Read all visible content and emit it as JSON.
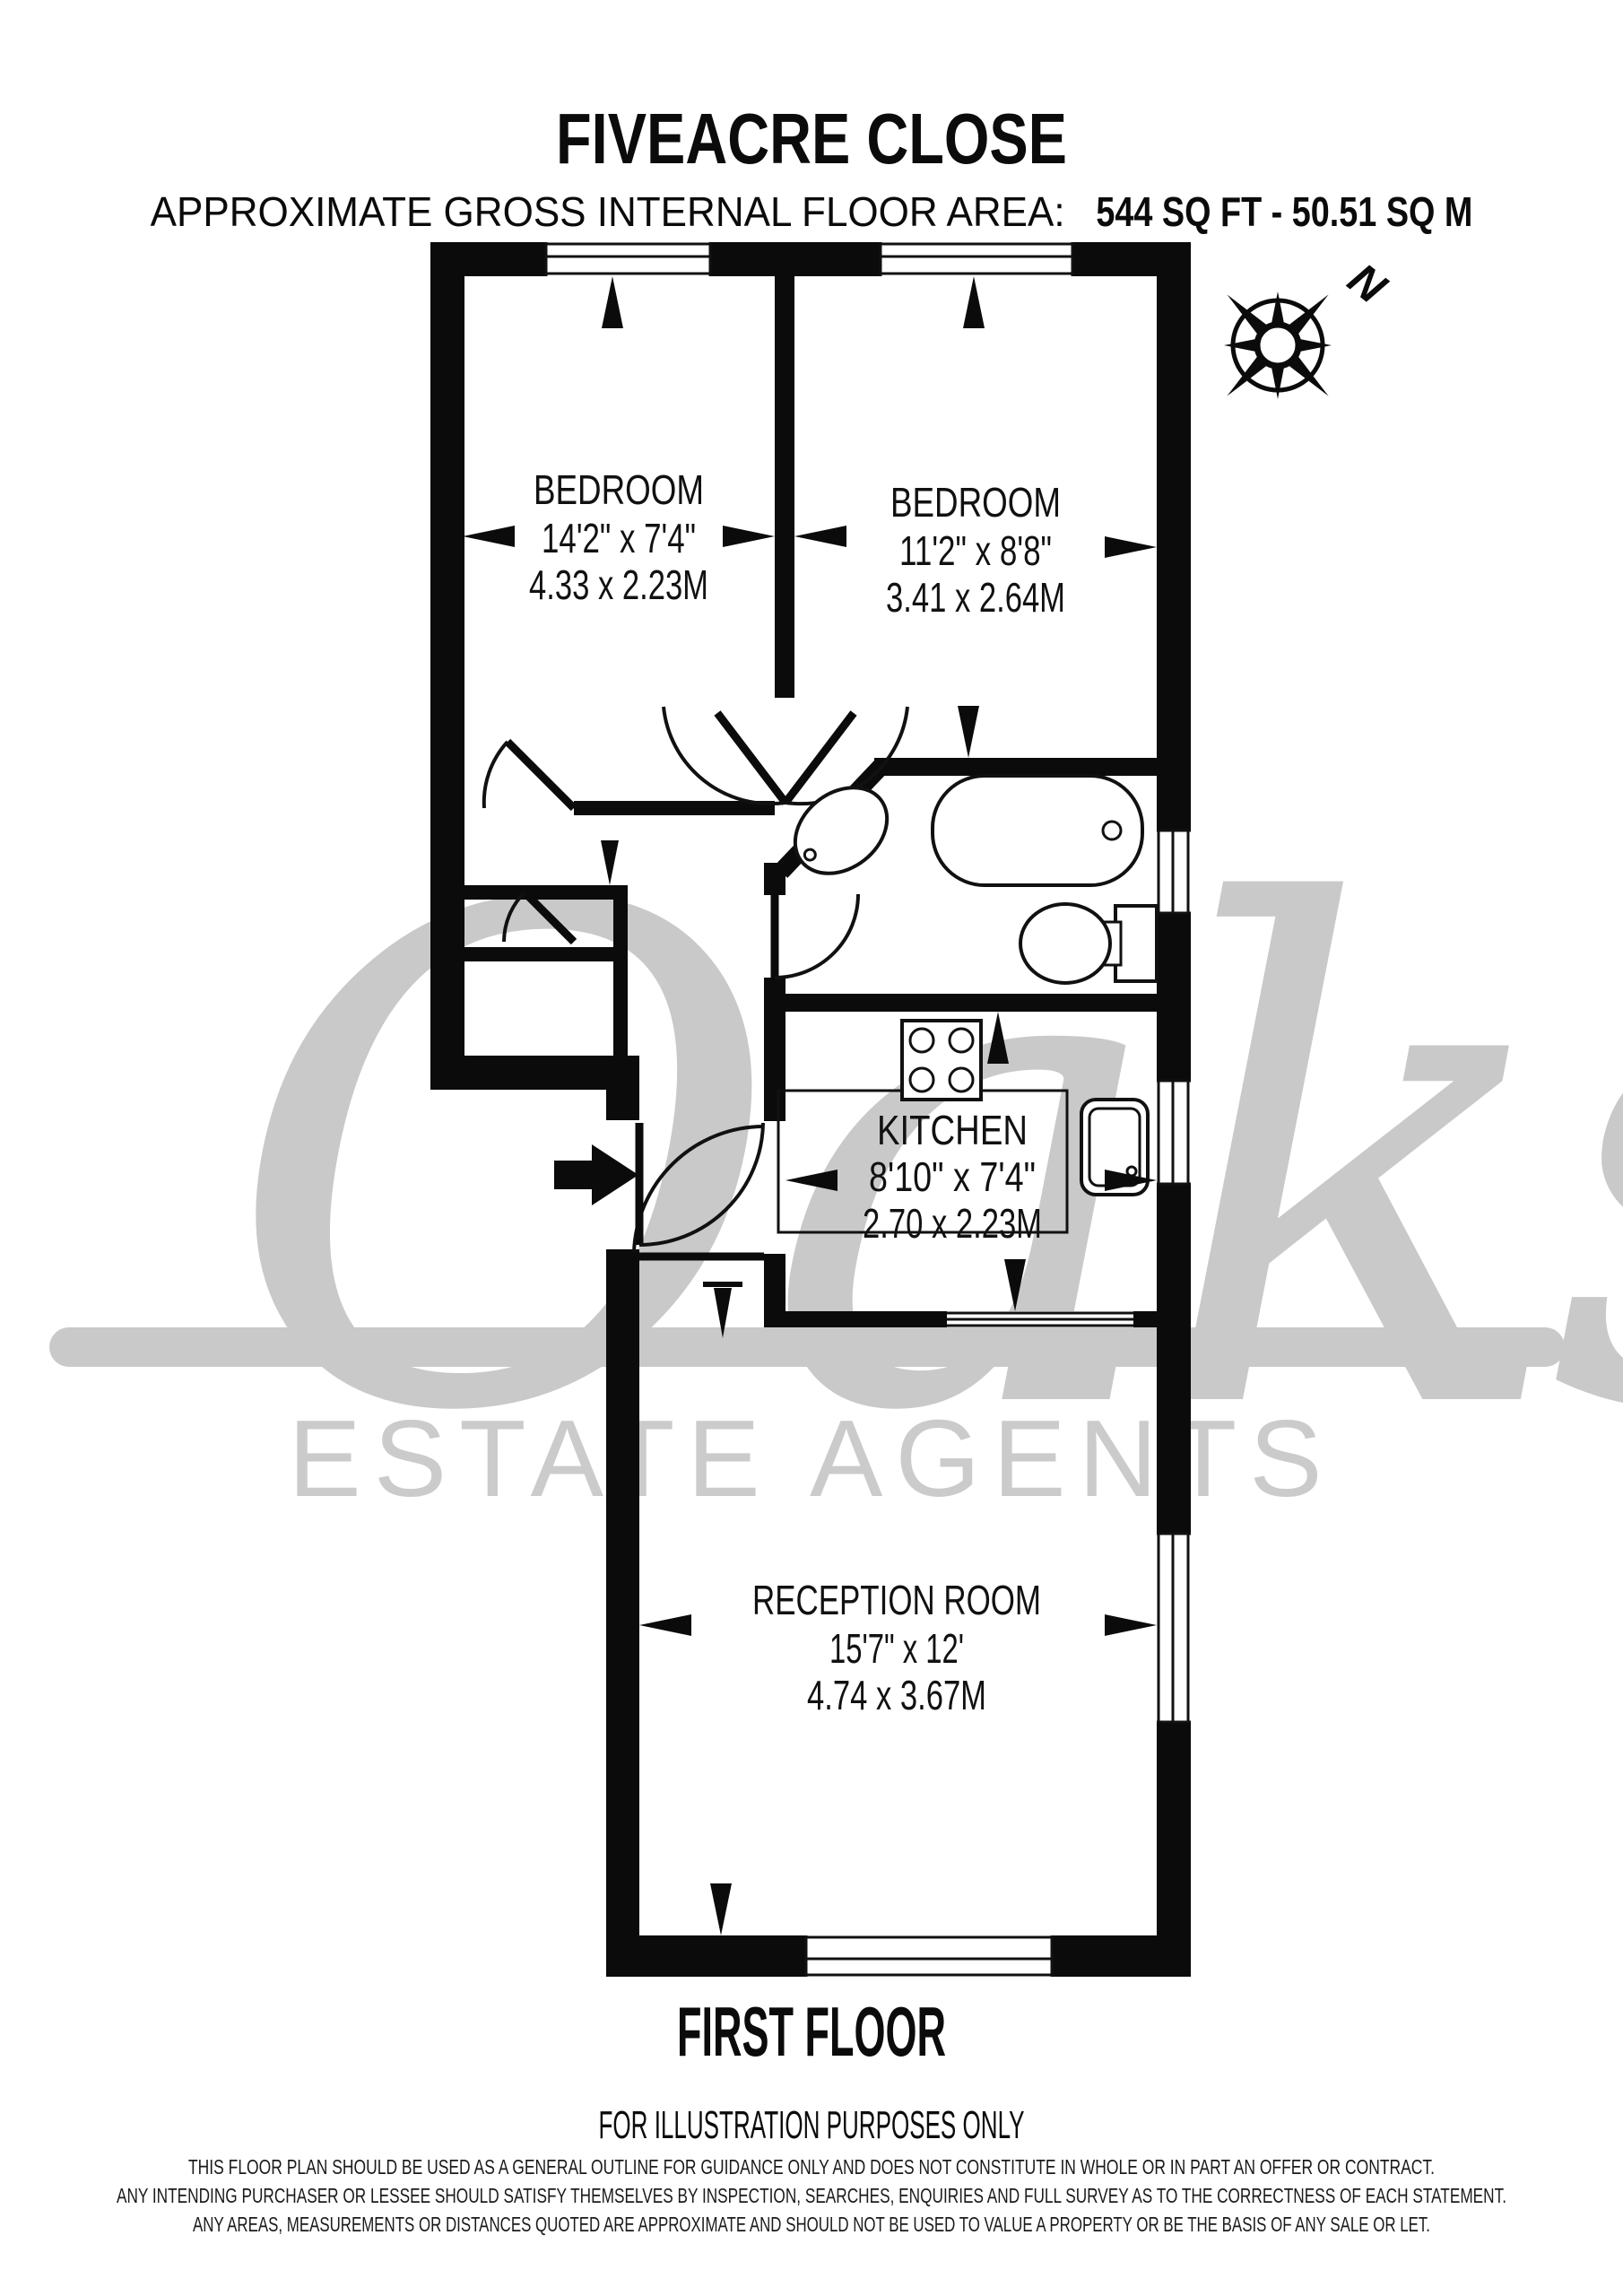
{
  "header": {
    "title": "FIVEACRE CLOSE",
    "area_label": "APPROXIMATE GROSS INTERNAL FLOOR AREA:",
    "area_value": "544 SQ FT - 50.51 SQ M"
  },
  "compass": {
    "north_label": "N"
  },
  "rooms": {
    "bedroom1": {
      "name": "BEDROOM",
      "imperial": "14'2\" x 7'4\"",
      "metric": "4.33 x 2.23M"
    },
    "bedroom2": {
      "name": "BEDROOM",
      "imperial": "11'2\" x 8'8\"",
      "metric": "3.41 x 2.64M"
    },
    "kitchen": {
      "name": "KITCHEN",
      "imperial": "8'10\" x 7'4\"",
      "metric": "2.70 x 2.23M"
    },
    "reception": {
      "name": "RECEPTION ROOM",
      "imperial": "15'7\" x 12'",
      "metric": "4.74 x 3.67M"
    }
  },
  "floor": {
    "label": "FIRST FLOOR",
    "note": "FOR ILLUSTRATION PURPOSES ONLY"
  },
  "disclaimer": {
    "line1": "THIS FLOOR PLAN SHOULD BE USED AS A GENERAL OUTLINE FOR GUIDANCE ONLY AND DOES NOT CONSTITUTE IN WHOLE OR IN PART AN OFFER OR CONTRACT.",
    "line2": "ANY INTENDING PURCHASER OR LESSEE SHOULD SATISFY THEMSELVES BY INSPECTION, SEARCHES, ENQUIRIES AND FULL SURVEY AS TO THE CORRECTNESS OF EACH STATEMENT.",
    "line3": "ANY AREAS, MEASUREMENTS OR DISTANCES QUOTED ARE APPROXIMATE AND SHOULD NOT BE USED TO VALUE A PROPERTY OR BE THE BASIS OF ANY SALE OR LET."
  },
  "watermark": {
    "script": "Oaks",
    "subtext": "ESTATE AGENTS"
  },
  "colors": {
    "wall": "#0b0b0b",
    "watermark": "#c9c9c9"
  }
}
